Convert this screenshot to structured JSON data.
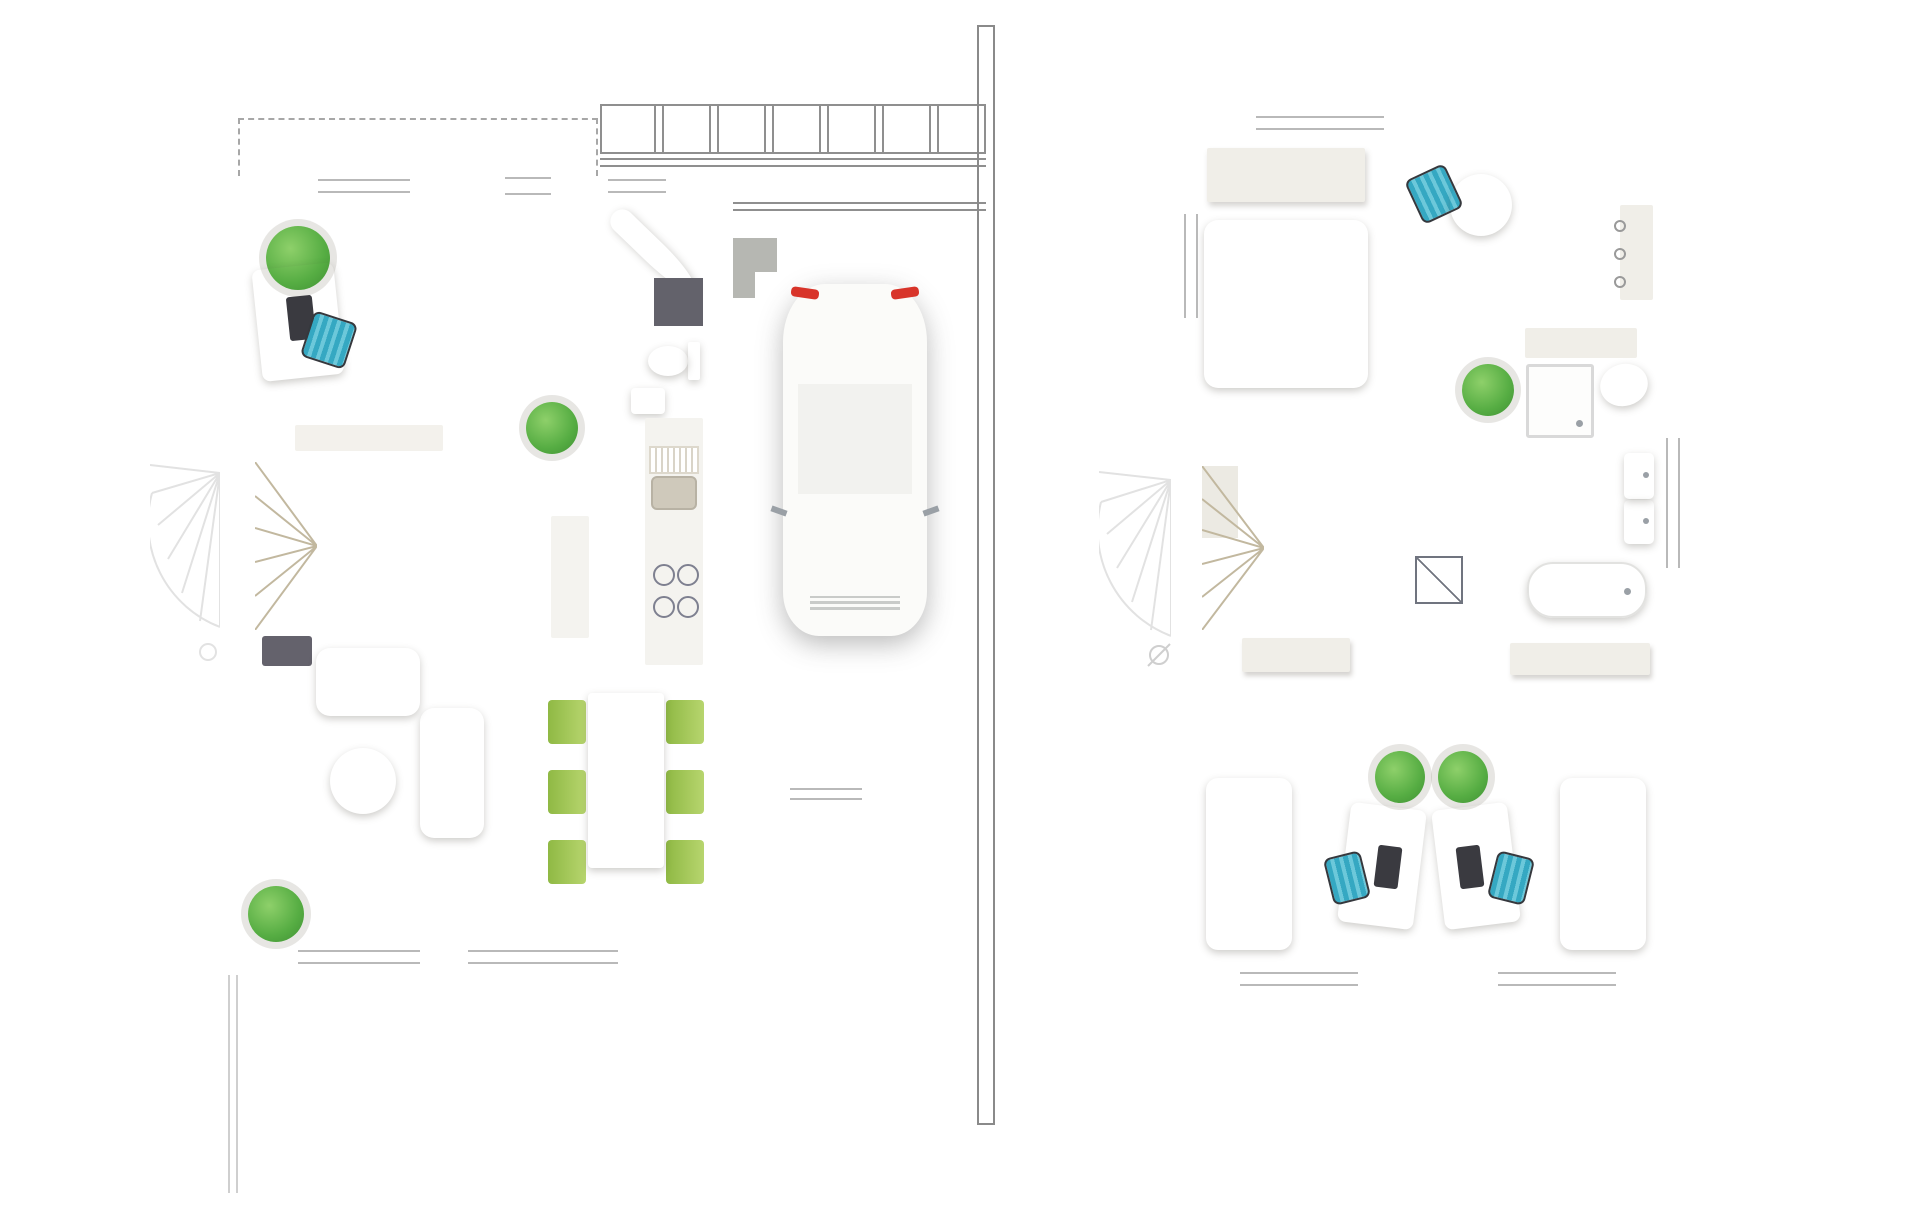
{
  "ground_floor": {
    "unit_label": "B11",
    "rooms": {
      "a11": {
        "label": "A1.1"
      },
      "a12": {
        "label": "A1.2"
      },
      "a13": {
        "label": "A1.3"
      },
      "a14": {
        "label": "A1.4"
      },
      "a15": {
        "label": "A1.5"
      },
      "a16": {
        "label": "A1.6"
      },
      "a17": {
        "label": "A1.7"
      }
    }
  },
  "upper_floor": {
    "rooms": {
      "a21": {
        "label": "A2.1"
      },
      "a22": {
        "label": "A2.2"
      },
      "a23": {
        "label": "A2.3"
      },
      "a24": {
        "label": "A2.4"
      },
      "a25": {
        "label": "A2.5"
      },
      "a26": {
        "label": "A2.6"
      }
    }
  },
  "scale_bar": {
    "start_label": "0 m",
    "end_label": "5 m",
    "segment_colors": [
      "#d9edfb",
      "#b3dcf7",
      "#8ccdf2",
      "#5cbdee",
      "#28b2e8"
    ]
  },
  "colors": {
    "wall": "#57524b",
    "floor_beige": "#ddd6c4",
    "floor_light": "#e5e3e4",
    "floor_kitchen": "#efeee9",
    "floor_garage": "#a8aaa5",
    "terrace": "#adaea9",
    "terrace_border": "#e9e9e7",
    "room_label": "#787d90",
    "unit_label": "#1d3a5e",
    "furniture_white": "#f6f5f1",
    "cushion": "#e4ddcd",
    "bed_red": "#b25d69",
    "chair_teal": "#4cb9d2",
    "chair_green": "#a9c95e",
    "plant_green": "#55b14a",
    "stair": "#dbd3c0",
    "stair_line": "#c2b89f",
    "rug": "#8c8077",
    "appliance": "#5a5c66",
    "outline_light": "#e2e2e2",
    "dash": "#8f8f8f",
    "hatch": "#8b8b8b",
    "scale_text": "#8b8e99",
    "car_glass": "#3b4048"
  }
}
